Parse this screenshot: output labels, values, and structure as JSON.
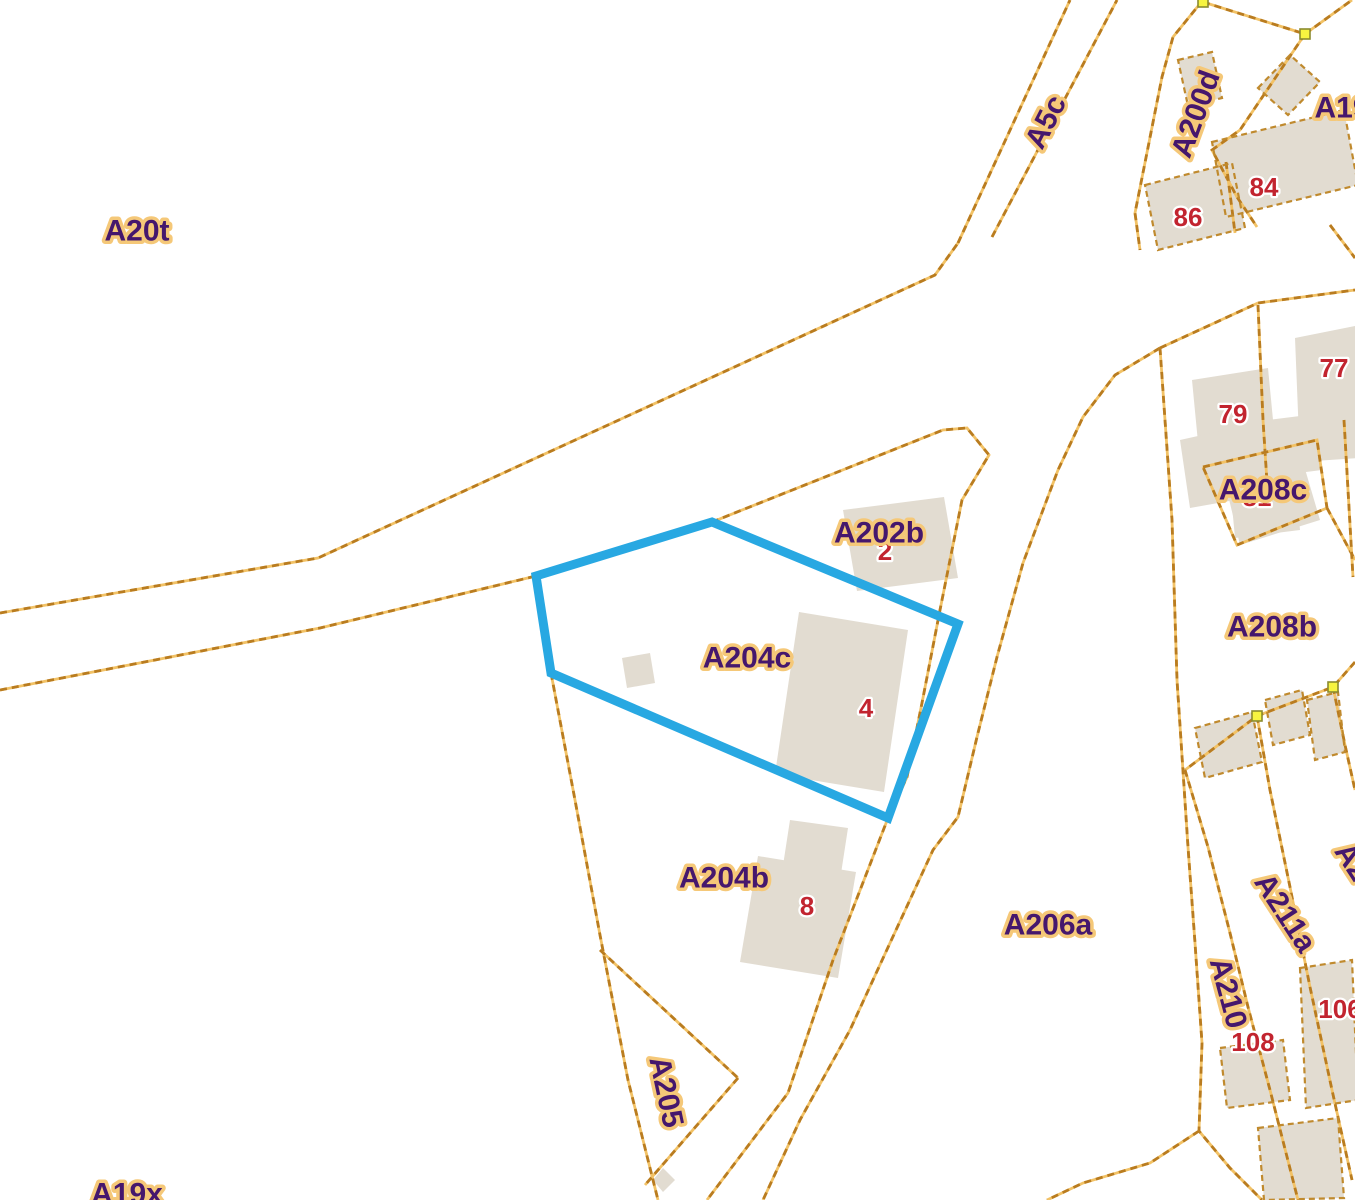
{
  "map": {
    "type": "cadastral-parcel-map",
    "selected_parcel": "A204c",
    "colors": {
      "background": "#ffffff",
      "boundary_dark": "#b97c20",
      "boundary_light": "#f2c266",
      "building_fill": "#e2dcd1",
      "building_outline": "#c08a2e",
      "label_fill": "#45176d",
      "label_halo": "#f5c878",
      "number_fill": "#c2242f",
      "number_halo": "#ffffff",
      "selection_stroke": "#28a8e2",
      "node_fill": "#f7f440",
      "node_stroke": "#8b8b2f"
    },
    "parcel_labels": [
      {
        "text": "A20t",
        "x": 137,
        "y": 231,
        "rot": 0
      },
      {
        "text": "A5c",
        "x": 1046,
        "y": 122,
        "rot": -63
      },
      {
        "text": "A200d",
        "x": 1196,
        "y": 114,
        "rot": -70
      },
      {
        "text": "A19",
        "x": 1342,
        "y": 108,
        "rot": 0
      },
      {
        "text": "A202b",
        "x": 879,
        "y": 533,
        "rot": 0
      },
      {
        "text": "A204c",
        "x": 747,
        "y": 658,
        "rot": 0
      },
      {
        "text": "A204b",
        "x": 724,
        "y": 878,
        "rot": 0
      },
      {
        "text": "A205",
        "x": 666,
        "y": 1092,
        "rot": 78
      },
      {
        "text": "A206a",
        "x": 1048,
        "y": 925,
        "rot": 0
      },
      {
        "text": "A208b",
        "x": 1272,
        "y": 627,
        "rot": 0
      },
      {
        "text": "A208c",
        "x": 1263,
        "y": 490,
        "rot": 0
      },
      {
        "text": "A211a",
        "x": 1285,
        "y": 913,
        "rot": 57
      },
      {
        "text": "A210",
        "x": 1228,
        "y": 993,
        "rot": 75
      },
      {
        "text": "A19x",
        "x": 127,
        "y": 1194,
        "rot": 0
      },
      {
        "text": "A2",
        "x": 1352,
        "y": 862,
        "rot": 57
      }
    ],
    "house_numbers": [
      {
        "text": "86",
        "x": 1188,
        "y": 217
      },
      {
        "text": "84",
        "x": 1264,
        "y": 187
      },
      {
        "text": "79",
        "x": 1233,
        "y": 414
      },
      {
        "text": "77",
        "x": 1334,
        "y": 368
      },
      {
        "text": "81",
        "x": 1257,
        "y": 497
      },
      {
        "text": "2",
        "x": 885,
        "y": 551
      },
      {
        "text": "4",
        "x": 866,
        "y": 708
      },
      {
        "text": "8",
        "x": 807,
        "y": 906
      },
      {
        "text": "108",
        "x": 1253,
        "y": 1042
      },
      {
        "text": "106",
        "x": 1340,
        "y": 1009
      }
    ],
    "selection_polygon": [
      [
        712,
        522
      ],
      [
        958,
        624
      ],
      [
        888,
        818
      ],
      [
        551,
        673
      ],
      [
        536,
        576
      ]
    ],
    "nodes": [
      [
        1203,
        2
      ],
      [
        1305,
        34
      ],
      [
        1333,
        687
      ],
      [
        1257,
        716
      ]
    ],
    "boundaries": [
      {
        "name": "road-north-edge",
        "pts": [
          [
            0,
            613
          ],
          [
            318,
            558
          ],
          [
            935,
            275
          ],
          [
            958,
            243
          ]
        ]
      },
      {
        "name": "a5c-west",
        "pts": [
          [
            958,
            243
          ],
          [
            1070,
            0
          ]
        ]
      },
      {
        "name": "a5c-east",
        "pts": [
          [
            992,
            237
          ],
          [
            1117,
            0
          ]
        ]
      },
      {
        "name": "east-main",
        "pts": [
          [
            0,
            690
          ],
          [
            320,
            628
          ],
          [
            536,
            576
          ],
          [
            712,
            522
          ],
          [
            943,
            430
          ],
          [
            967,
            428
          ],
          [
            989,
            455
          ],
          [
            962,
            500
          ],
          [
            940,
            610
          ],
          [
            922,
            703
          ],
          [
            907,
            777
          ],
          [
            888,
            818
          ],
          [
            833,
            960
          ],
          [
            788,
            1093
          ],
          [
            707,
            1200
          ]
        ]
      },
      {
        "name": "a206a-west",
        "pts": [
          [
            1160,
            348
          ],
          [
            1115,
            375
          ],
          [
            1083,
            417
          ],
          [
            1058,
            470
          ],
          [
            1023,
            563
          ],
          [
            997,
            657
          ],
          [
            977,
            737
          ],
          [
            958,
            817
          ],
          [
            933,
            850
          ],
          [
            890,
            943
          ],
          [
            850,
            1030
          ],
          [
            800,
            1120
          ],
          [
            763,
            1200
          ]
        ]
      },
      {
        "name": "a206a-east",
        "pts": [
          [
            1160,
            348
          ],
          [
            1165,
            420
          ],
          [
            1172,
            520
          ],
          [
            1177,
            680
          ],
          [
            1188,
            847
          ],
          [
            1195,
            943
          ],
          [
            1202,
            1043
          ],
          [
            1199,
            1131
          ],
          [
            1230,
            1168
          ],
          [
            1262,
            1200
          ]
        ]
      },
      {
        "name": "corner-branch",
        "pts": [
          [
            1199,
            1131
          ],
          [
            1150,
            1163
          ],
          [
            1083,
            1183
          ],
          [
            1047,
            1200
          ]
        ]
      },
      {
        "name": "block-north",
        "pts": [
          [
            1160,
            348
          ],
          [
            1258,
            303
          ],
          [
            1355,
            290
          ]
        ]
      },
      {
        "name": "block-inner-vertical",
        "pts": [
          [
            1258,
            305
          ],
          [
            1263,
            420
          ],
          [
            1268,
            498
          ]
        ]
      },
      {
        "name": "a208c-square",
        "pts": [
          [
            1203,
            467
          ],
          [
            1317,
            440
          ],
          [
            1327,
            508
          ],
          [
            1237,
            545
          ],
          [
            1203,
            467
          ]
        ]
      },
      {
        "name": "a208c-tail",
        "pts": [
          [
            1327,
            508
          ],
          [
            1355,
            560
          ]
        ]
      },
      {
        "name": "block-right-edge",
        "pts": [
          [
            1344,
            420
          ],
          [
            1353,
            577
          ]
        ]
      },
      {
        "name": "strip-top",
        "pts": [
          [
            1355,
            662
          ],
          [
            1333,
            687
          ],
          [
            1257,
            716
          ],
          [
            1185,
            770
          ]
        ]
      },
      {
        "name": "strip-s1",
        "pts": [
          [
            1185,
            770
          ],
          [
            1208,
            847
          ],
          [
            1230,
            933
          ],
          [
            1248,
            1007
          ],
          [
            1270,
            1090
          ],
          [
            1298,
            1200
          ]
        ]
      },
      {
        "name": "strip-s2",
        "pts": [
          [
            1257,
            716
          ],
          [
            1270,
            790
          ],
          [
            1290,
            887
          ],
          [
            1310,
            987
          ],
          [
            1332,
            1090
          ],
          [
            1352,
            1180
          ]
        ]
      },
      {
        "name": "strip-s3",
        "pts": [
          [
            1333,
            687
          ],
          [
            1345,
            745
          ],
          [
            1355,
            790
          ]
        ]
      },
      {
        "name": "block8684-south",
        "pts": [
          [
            1330,
            225
          ],
          [
            1355,
            258
          ]
        ]
      },
      {
        "name": "a200d-west",
        "pts": [
          [
            1203,
            0
          ],
          [
            1173,
            37
          ],
          [
            1162,
            77
          ],
          [
            1135,
            213
          ],
          [
            1140,
            250
          ]
        ]
      },
      {
        "name": "node-line-left",
        "pts": [
          [
            1203,
            2
          ],
          [
            1305,
            34
          ]
        ]
      },
      {
        "name": "node-line-right",
        "pts": [
          [
            1305,
            34
          ],
          [
            1352,
            0
          ]
        ]
      },
      {
        "name": "p84-west",
        "pts": [
          [
            1305,
            34
          ],
          [
            1240,
            130
          ],
          [
            1212,
            150
          ],
          [
            1237,
            197
          ],
          [
            1257,
            227
          ]
        ]
      },
      {
        "name": "divider-86-84",
        "pts": [
          [
            1226,
            162
          ],
          [
            1235,
            233
          ]
        ]
      },
      {
        "name": "a205-west",
        "pts": [
          [
            551,
            673
          ],
          [
            575,
            800
          ],
          [
            600,
            935
          ],
          [
            628,
            1080
          ],
          [
            658,
            1200
          ]
        ]
      },
      {
        "name": "a205-northeast",
        "pts": [
          [
            600,
            950
          ],
          [
            738,
            1078
          ]
        ]
      },
      {
        "name": "a205-southeast",
        "pts": [
          [
            738,
            1078
          ],
          [
            645,
            1185
          ]
        ]
      }
    ],
    "buildings": [
      {
        "name": "a202b-building",
        "outlined": false,
        "pts": [
          [
            843,
            510
          ],
          [
            944,
            497
          ],
          [
            958,
            578
          ],
          [
            857,
            591
          ]
        ]
      },
      {
        "name": "a204c-building",
        "outlined": false,
        "pts": [
          [
            799,
            612
          ],
          [
            908,
            630
          ],
          [
            884,
            792
          ],
          [
            775,
            774
          ]
        ]
      },
      {
        "name": "a204c-shed",
        "outlined": false,
        "pts": [
          [
            622,
            658
          ],
          [
            650,
            653
          ],
          [
            655,
            683
          ],
          [
            627,
            688
          ]
        ]
      },
      {
        "name": "a204b-building-top",
        "outlined": false,
        "pts": [
          [
            790,
            820
          ],
          [
            848,
            828
          ],
          [
            840,
            880
          ],
          [
            782,
            872
          ]
        ]
      },
      {
        "name": "a204b-building-main",
        "outlined": false,
        "pts": [
          [
            758,
            856
          ],
          [
            856,
            872
          ],
          [
            838,
            978
          ],
          [
            740,
            962
          ]
        ]
      },
      {
        "name": "building-79a",
        "outlined": false,
        "pts": [
          [
            1192,
            380
          ],
          [
            1268,
            368
          ],
          [
            1278,
            472
          ],
          [
            1202,
            484
          ]
        ]
      },
      {
        "name": "building-79b",
        "outlined": false,
        "pts": [
          [
            1268,
            420
          ],
          [
            1316,
            414
          ],
          [
            1322,
            470
          ],
          [
            1274,
            476
          ]
        ]
      },
      {
        "name": "building-79c",
        "outlined": false,
        "pts": [
          [
            1230,
            484
          ],
          [
            1295,
            476
          ],
          [
            1300,
            530
          ],
          [
            1235,
            538
          ]
        ]
      },
      {
        "name": "building-77",
        "outlined": false,
        "pts": [
          [
            1295,
            338
          ],
          [
            1355,
            326
          ],
          [
            1358,
            458
          ],
          [
            1300,
            462
          ]
        ]
      },
      {
        "name": "a208c-infill",
        "outlined": false,
        "pts": [
          [
            1222,
            470
          ],
          [
            1300,
            452
          ],
          [
            1320,
            520
          ],
          [
            1240,
            545
          ]
        ]
      },
      {
        "name": "a208c-infill-2",
        "outlined": false,
        "pts": [
          [
            1180,
            440
          ],
          [
            1225,
            430
          ],
          [
            1235,
            500
          ],
          [
            1190,
            508
          ]
        ]
      },
      {
        "name": "a200d-building",
        "outlined": true,
        "pts": [
          [
            1178,
            60
          ],
          [
            1212,
            52
          ],
          [
            1222,
            98
          ],
          [
            1188,
            106
          ]
        ]
      },
      {
        "name": "a19-building",
        "outlined": true,
        "pts": [
          [
            1258,
            88
          ],
          [
            1290,
            55
          ],
          [
            1320,
            82
          ],
          [
            1288,
            115
          ]
        ]
      },
      {
        "name": "building-86",
        "outlined": true,
        "pts": [
          [
            1145,
            185
          ],
          [
            1232,
            163
          ],
          [
            1245,
            228
          ],
          [
            1158,
            250
          ]
        ]
      },
      {
        "name": "building-84",
        "outlined": true,
        "pts": [
          [
            1212,
            142
          ],
          [
            1344,
            110
          ],
          [
            1358,
            185
          ],
          [
            1226,
            217
          ]
        ]
      },
      {
        "name": "strip-building-t1",
        "outlined": true,
        "pts": [
          [
            1195,
            728
          ],
          [
            1252,
            712
          ],
          [
            1262,
            762
          ],
          [
            1205,
            778
          ]
        ]
      },
      {
        "name": "strip-building-t2",
        "outlined": true,
        "pts": [
          [
            1265,
            700
          ],
          [
            1302,
            690
          ],
          [
            1310,
            735
          ],
          [
            1273,
            745
          ]
        ]
      },
      {
        "name": "strip-building-t3",
        "outlined": true,
        "pts": [
          [
            1307,
            700
          ],
          [
            1338,
            692
          ],
          [
            1345,
            752
          ],
          [
            1315,
            760
          ]
        ]
      },
      {
        "name": "strip-building-b1",
        "outlined": true,
        "pts": [
          [
            1220,
            1048
          ],
          [
            1283,
            1040
          ],
          [
            1290,
            1100
          ],
          [
            1227,
            1108
          ]
        ]
      },
      {
        "name": "strip-building-b2",
        "outlined": true,
        "pts": [
          [
            1300,
            968
          ],
          [
            1352,
            960
          ],
          [
            1358,
            1100
          ],
          [
            1306,
            1108
          ]
        ]
      },
      {
        "name": "strip-building-b3",
        "outlined": true,
        "pts": [
          [
            1258,
            1128
          ],
          [
            1338,
            1118
          ],
          [
            1344,
            1198
          ],
          [
            1264,
            1200
          ]
        ]
      },
      {
        "name": "small-diamond",
        "outlined": false,
        "pts": [
          [
            653,
            1180
          ],
          [
            663,
            1168
          ],
          [
            675,
            1180
          ],
          [
            663,
            1192
          ]
        ]
      }
    ],
    "style": {
      "label_font_size": 30,
      "number_font_size": 26,
      "boundary_width": 2.8,
      "selection_width": 9
    }
  }
}
